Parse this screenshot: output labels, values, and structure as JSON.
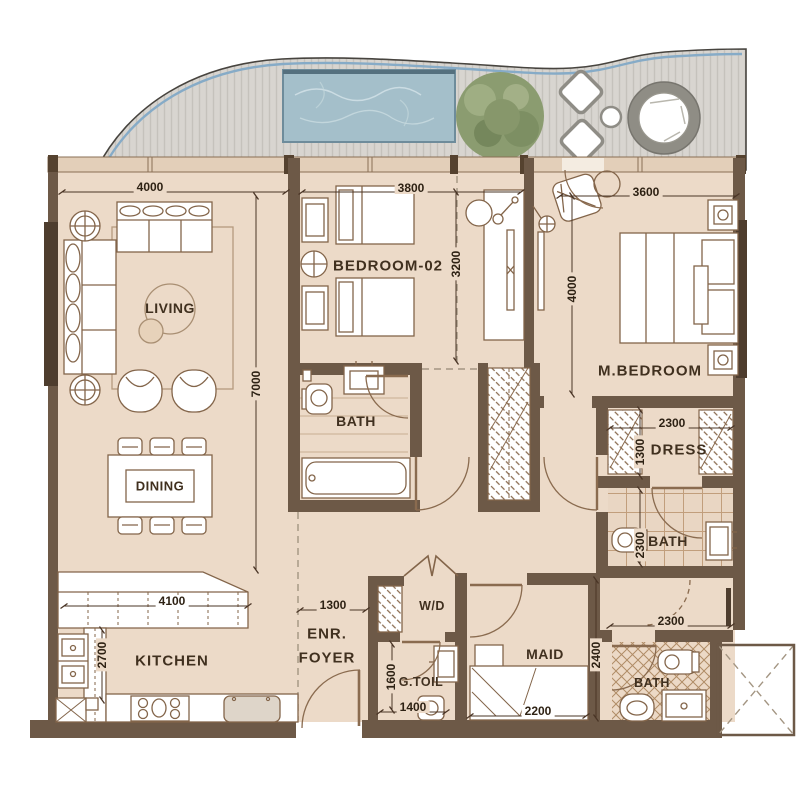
{
  "title": "Apartment floor plan with pool terrace",
  "rooms": {
    "living": "LIVING",
    "dining": "DINING",
    "bedroom2": "BEDROOM-02",
    "master_bedroom": "M.BEDROOM",
    "bath2": "BATH",
    "dress": "DRESS",
    "master_bath": "BATH",
    "kitchen": "KITCHEN",
    "foyer_l1": "ENR.",
    "foyer_l2": "FOYER",
    "wd": "W/D",
    "gtoilet": "G.TOIL",
    "maid": "MAID",
    "maid_bath": "BATH"
  },
  "dims": {
    "living_w": "4000",
    "bed2_w": "3800",
    "master_w": "3600",
    "bed2_h": "3200",
    "master_h": "4000",
    "living_h": "7000",
    "dress_w": "2300",
    "dress_h": "1300",
    "mbath_h": "2300",
    "mbath_w": "2300",
    "kitchen_w": "4100",
    "kitchen_h": "2700",
    "foyer_w": "1300",
    "gtoil_h": "1600",
    "gtoil_w": "1400",
    "maid_bed_w": "2200",
    "maid_h": "2400"
  },
  "colors": {
    "wall": "#6d5947",
    "floor": "#ecdac8",
    "window_frame": "#4e3d2e",
    "deck": "#d8d5d0",
    "pool_water": "#a4bfca",
    "pool_edge": "#5d7382",
    "tree": "#8b9c70",
    "furniture_line": "#83654a",
    "dim_text": "#2e2214"
  }
}
